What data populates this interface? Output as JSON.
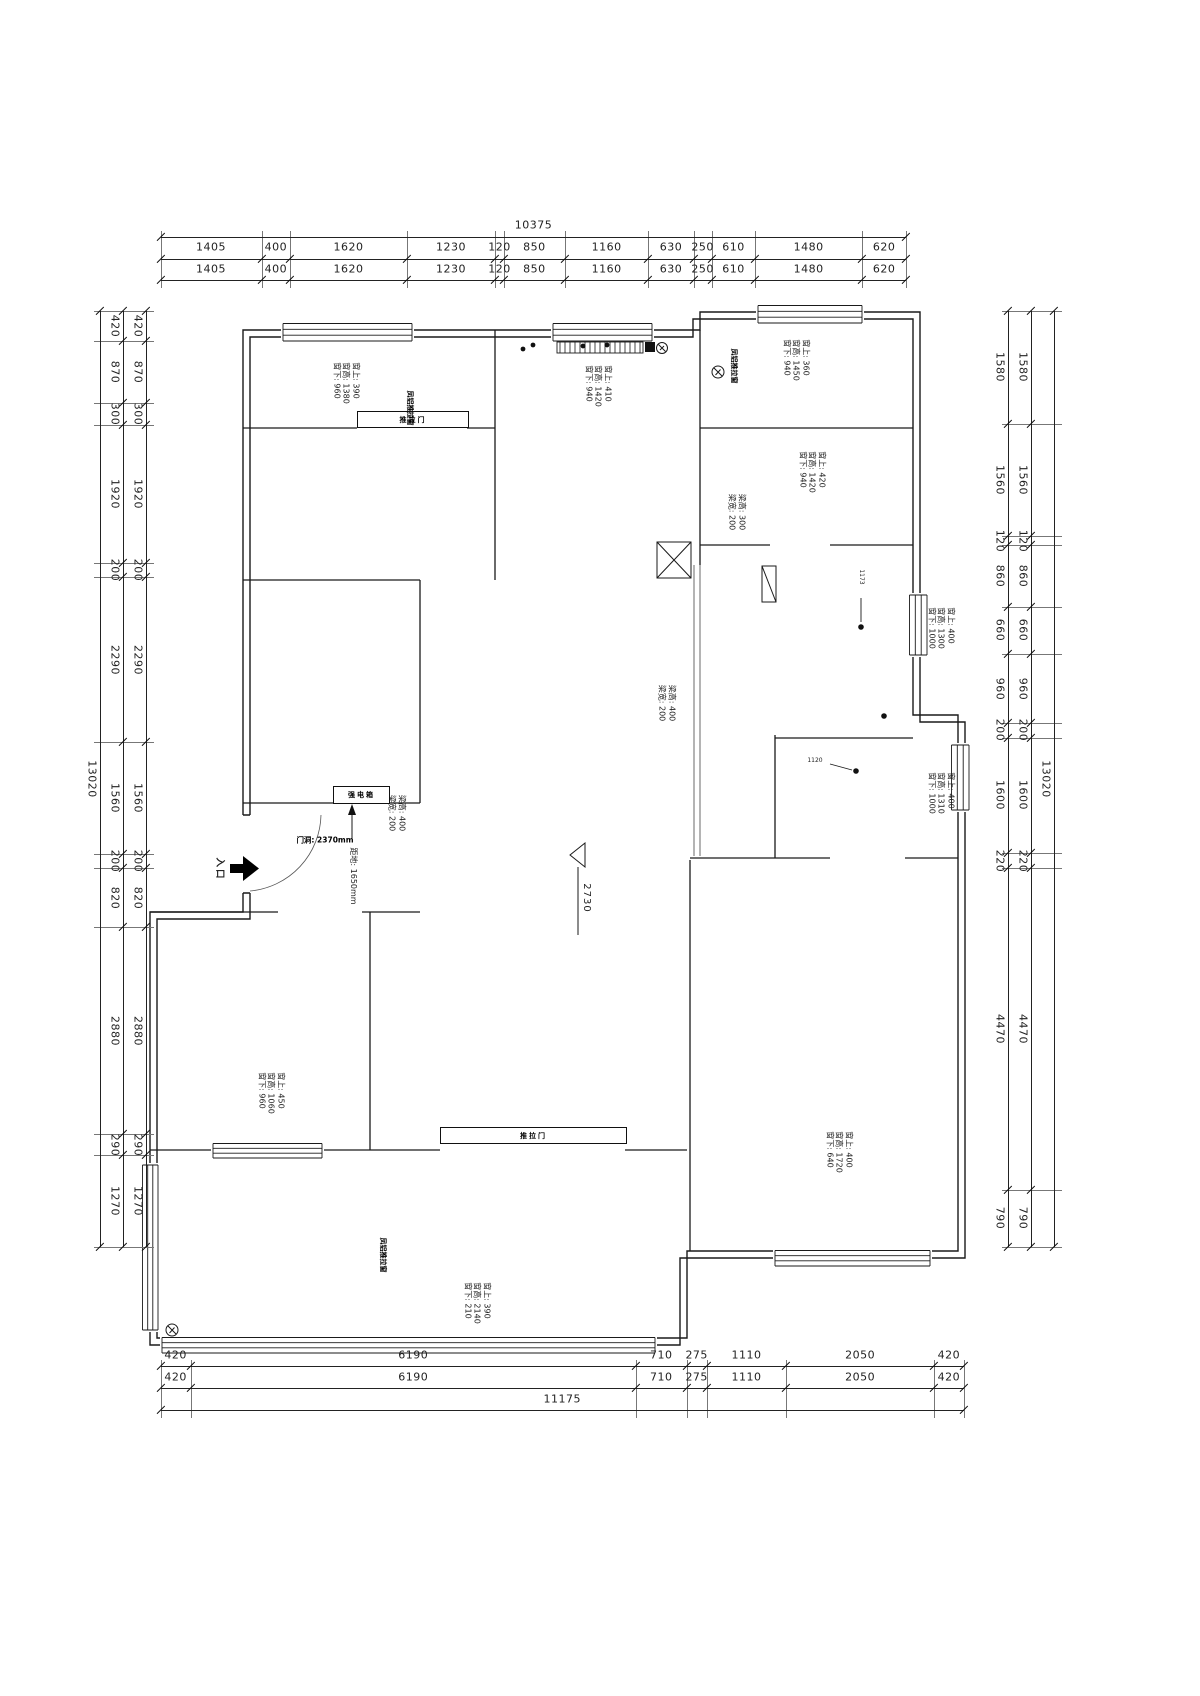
{
  "dimensions": {
    "top": {
      "total": "10375",
      "segments": [
        "1405",
        "400",
        "1620",
        "1230",
        "120",
        "850",
        "1160",
        "630",
        "250",
        "610",
        "1480",
        "620"
      ]
    },
    "bottom": {
      "total": "11175",
      "segments": [
        "420",
        "6190",
        "710",
        "275",
        "1110",
        "2050",
        "420"
      ]
    },
    "left": {
      "total": "13020",
      "segments": [
        "420",
        "870",
        "300",
        "1920",
        "200",
        "2290",
        "1560",
        "200",
        "820",
        "2880",
        "290",
        "1270"
      ]
    },
    "right": {
      "total": "13020",
      "segments": [
        "1580",
        "1560",
        "120",
        "860",
        "660",
        "960",
        "200",
        "1600",
        "220",
        "4470",
        "790"
      ]
    }
  },
  "annotations": [
    {
      "id": "win-study",
      "lines": [
        "窗上: 390",
        "窗高: 1380",
        "窗下: 960"
      ]
    },
    {
      "id": "win-kitchen",
      "lines": [
        "窗上: 410",
        "窗高: 1420",
        "窗下: 940"
      ]
    },
    {
      "id": "win-bath",
      "lines": [
        "窗上: 360",
        "窗高: 1450",
        "窗下: 940"
      ]
    },
    {
      "id": "win-bed2",
      "lines": [
        "窗上: 420",
        "窗高: 1420",
        "窗下: 940"
      ]
    },
    {
      "id": "beam-bath",
      "lines": [
        "梁高: 300",
        "梁宽: 200"
      ]
    },
    {
      "id": "win-right-mid",
      "lines": [
        "窗上: 400",
        "窗高: 1300",
        "窗下: 1000"
      ]
    },
    {
      "id": "beam-living",
      "lines": [
        "梁高: 400",
        "梁宽: 200"
      ]
    },
    {
      "id": "beam-entry",
      "lines": [
        "梁高: 400",
        "梁宽: 200"
      ]
    },
    {
      "id": "win-right-low",
      "lines": [
        "窗上: 400",
        "窗高: 1310",
        "窗下: 1000"
      ]
    },
    {
      "id": "win-master",
      "lines": [
        "窗上: 400",
        "窗高: 1720",
        "窗下: 640"
      ]
    },
    {
      "id": "win-bed3",
      "lines": [
        "窗上: 450",
        "窗高: 1060",
        "窗下: 960"
      ]
    },
    {
      "id": "win-balcony",
      "lines": [
        "窗上: 390",
        "窗高: 2140",
        "窗下: 210"
      ]
    },
    {
      "id": "floor-height",
      "lines": [
        "距地: 1650mm"
      ]
    },
    {
      "id": "entry",
      "lines": [
        "入口"
      ]
    },
    {
      "id": "level",
      "lines": [
        "2730"
      ]
    },
    {
      "id": "h1173",
      "lines": [
        "1173"
      ]
    },
    {
      "id": "h1120",
      "lines": [
        "1120"
      ]
    }
  ],
  "labels": [
    {
      "id": "door-study",
      "text": "推拉门"
    },
    {
      "id": "door-balcony",
      "text": "推拉门"
    },
    {
      "id": "power-box",
      "text": "强电箱"
    },
    {
      "id": "door-opening",
      "text": "门洞: 2370mm"
    },
    {
      "id": "win-brand-study",
      "text": "凤铝推拉窗"
    },
    {
      "id": "win-brand-bath",
      "text": "凤铝推拉窗"
    },
    {
      "id": "win-brand-balcony",
      "text": "凤铝推拉窗"
    }
  ],
  "colors": {
    "line": "#1a1a1a",
    "background": "#ffffff"
  }
}
